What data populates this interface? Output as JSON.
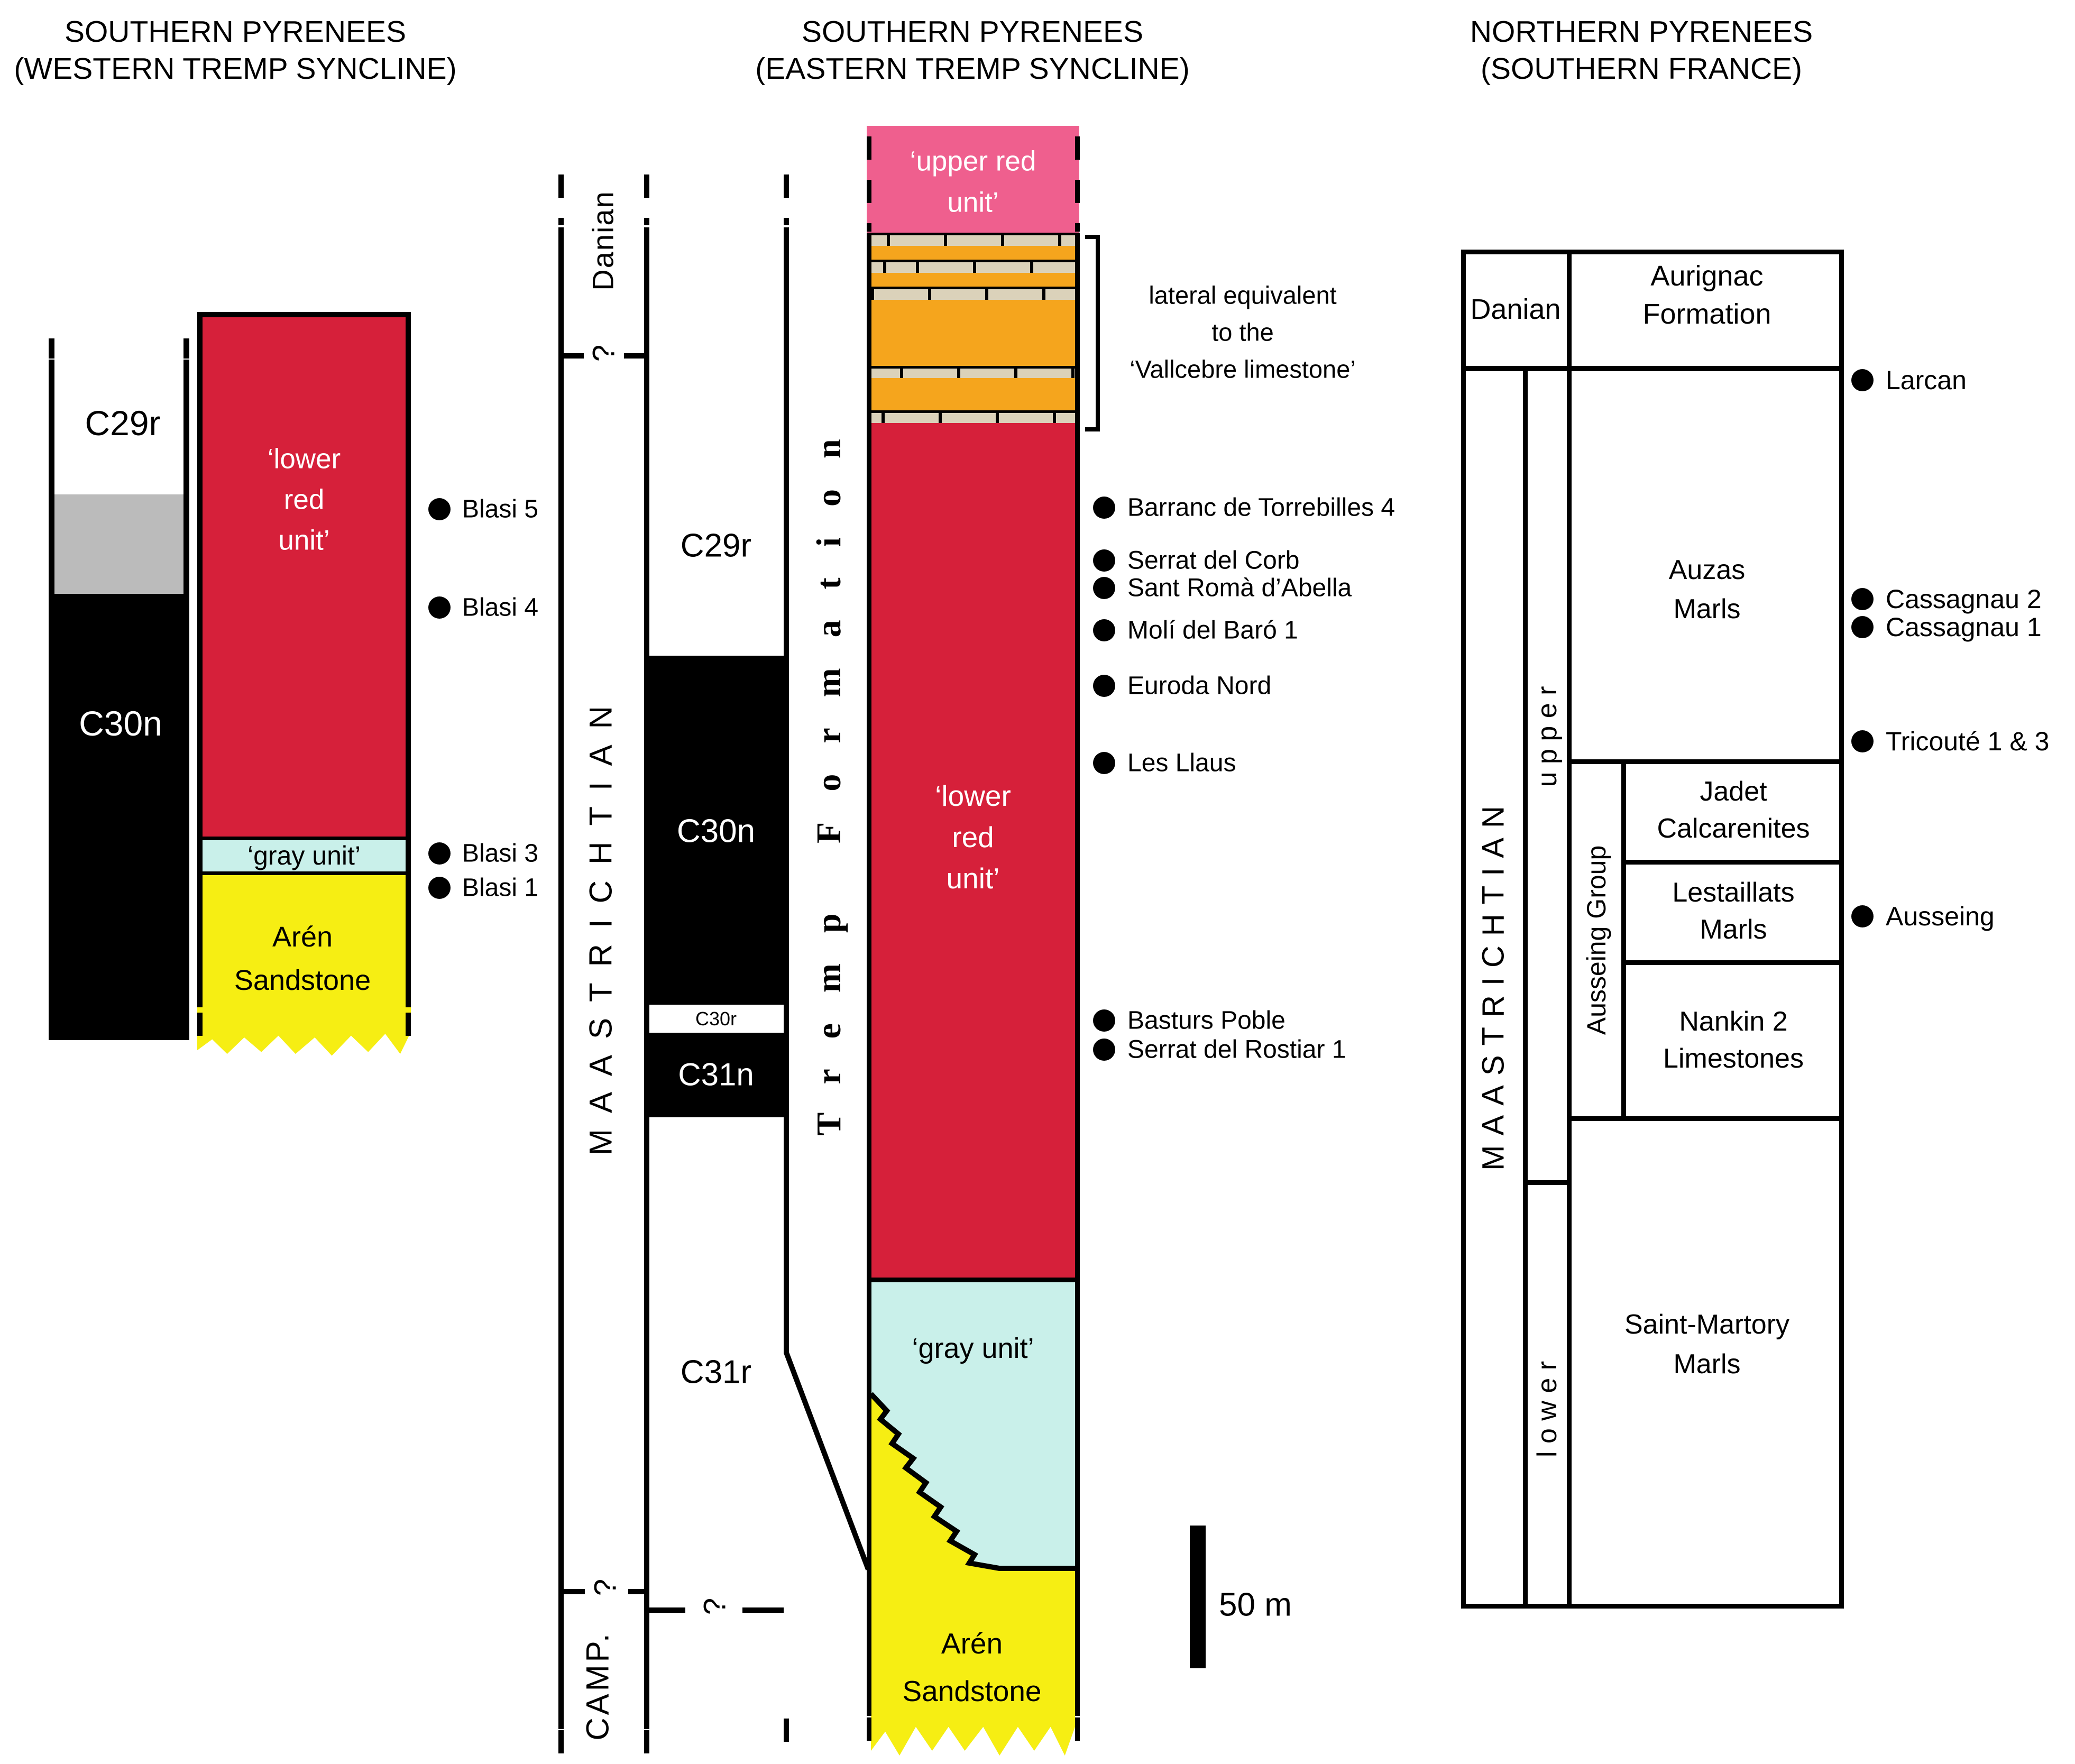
{
  "colors": {
    "red": "#D6203A",
    "pink": "#EF5F8E",
    "orange": "#F5A51D",
    "limestone": "#DBD2BA",
    "gray_unit_cyan": "#C9F0EA",
    "aren_yellow": "#F6EE13",
    "chron_gray": "#BBBBBB",
    "black": "#000000"
  },
  "titles": {
    "left": [
      "SOUTHERN PYRENEES",
      "(WESTERN TREMP SYNCLINE)"
    ],
    "middle": [
      "SOUTHERN PYRENEES",
      "(EASTERN TREMP SYNCLINE)"
    ],
    "right": [
      "NORTHERN PYRENEES",
      "(SOUTHERN FRANCE)"
    ]
  },
  "west": {
    "chrons": {
      "c29r": "C29r",
      "c30n": "C30n"
    },
    "units": {
      "lower_red": [
        "‘lower",
        "red",
        "unit’"
      ],
      "gray": "‘gray unit’",
      "aren": [
        "Arén",
        "Sandstone"
      ]
    },
    "sites": [
      "Blasi 5",
      "Blasi 4",
      "Blasi 3",
      "Blasi 1"
    ]
  },
  "east": {
    "stages": {
      "danian": "Danian",
      "maastrichtian": "MAASTRICHTIAN",
      "campanian": "CAMP."
    },
    "q": "?",
    "chrons": {
      "c29r": "C29r",
      "c30n": "C30n",
      "c30r": "C30r",
      "c31n": "C31n",
      "c31r": "C31r"
    },
    "formation": "Tremp Formation",
    "units": {
      "upper_red": [
        "‘upper red",
        "unit’"
      ],
      "lower_red": [
        "‘lower",
        "red",
        "unit’"
      ],
      "gray": "‘gray unit’",
      "aren": [
        "Arén",
        "Sandstone"
      ]
    },
    "bracket": [
      "lateral equivalent",
      "to the",
      "‘Vallcebre limestone’"
    ],
    "sites": [
      "Barranc de Torrebilles 4",
      "Serrat del Corb",
      "Sant Romà d’Abella",
      "Molí del Baró 1",
      "Euroda Nord",
      "Les Llaus",
      "Basturs Poble",
      "Serrat del Rostiar 1"
    ],
    "scale_bar": "50 m"
  },
  "north": {
    "stages": {
      "danian": "Danian",
      "maastrichtian": "MAASTRICHTIAN",
      "upper": "u p p e r",
      "lower": "l o w e r"
    },
    "group": "Ausseing Group",
    "units": {
      "aurignac": [
        "Aurignac",
        "Formation"
      ],
      "auzas": [
        "Auzas",
        "Marls"
      ],
      "jadet": [
        "Jadet",
        "Calcarenites"
      ],
      "lestaillats": [
        "Lestaillats",
        "Marls"
      ],
      "nankin": [
        "Nankin 2",
        "Limestones"
      ],
      "saint_martory": [
        "Saint-Martory",
        "Marls"
      ]
    },
    "sites": [
      "Larcan",
      "Cassagnau 2",
      "Cassagnau 1",
      "Tricouté 1 & 3",
      "Ausseing"
    ]
  }
}
